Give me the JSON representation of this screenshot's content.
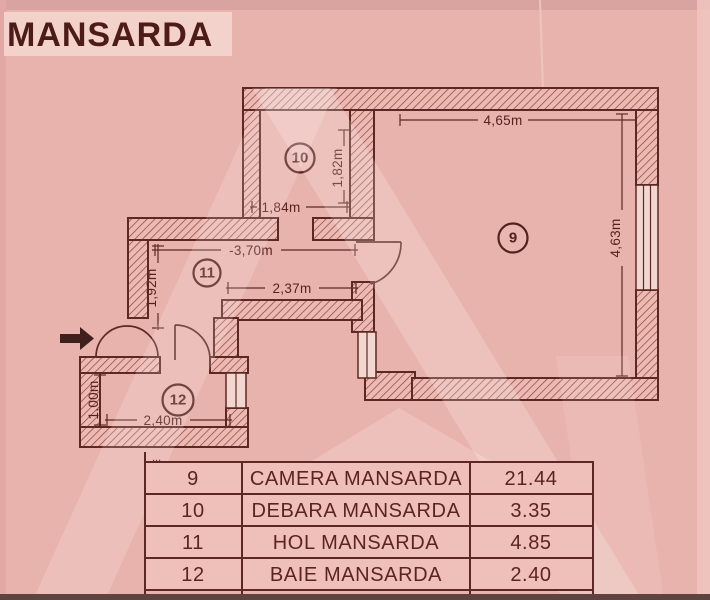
{
  "title": "MANSARDA",
  "plan": {
    "rooms": {
      "camera": "9",
      "debara": "10",
      "hol": "11",
      "baie": "12"
    },
    "dimensions": {
      "room9_width": "4,65m",
      "room9_height": "4,63m",
      "room10_height": "1,82m",
      "room10_width": "1,84m",
      "hall_width": "-3,70m",
      "hall_inner_width": "2,37m",
      "hall_height": "1,92m",
      "bath_height": "1,00m",
      "bath_width": "2,40m"
    }
  },
  "table": {
    "cutoff_dots": "...",
    "rows": [
      {
        "number": "9",
        "name": "CAMERA MANSARDA",
        "area": "21.44"
      },
      {
        "number": "10",
        "name": "DEBARA MANSARDA",
        "area": "3.35"
      },
      {
        "number": "11",
        "name": "HOL MANSARDA",
        "area": "4.85"
      },
      {
        "number": "12",
        "name": "BAIE MANSARDA",
        "area": "2.40"
      }
    ]
  },
  "colors": {
    "paper_pink": "#e9b3ad",
    "title_strip": "#f3d2cb",
    "ink": "#5d2823",
    "hatch": "#8a423a"
  }
}
